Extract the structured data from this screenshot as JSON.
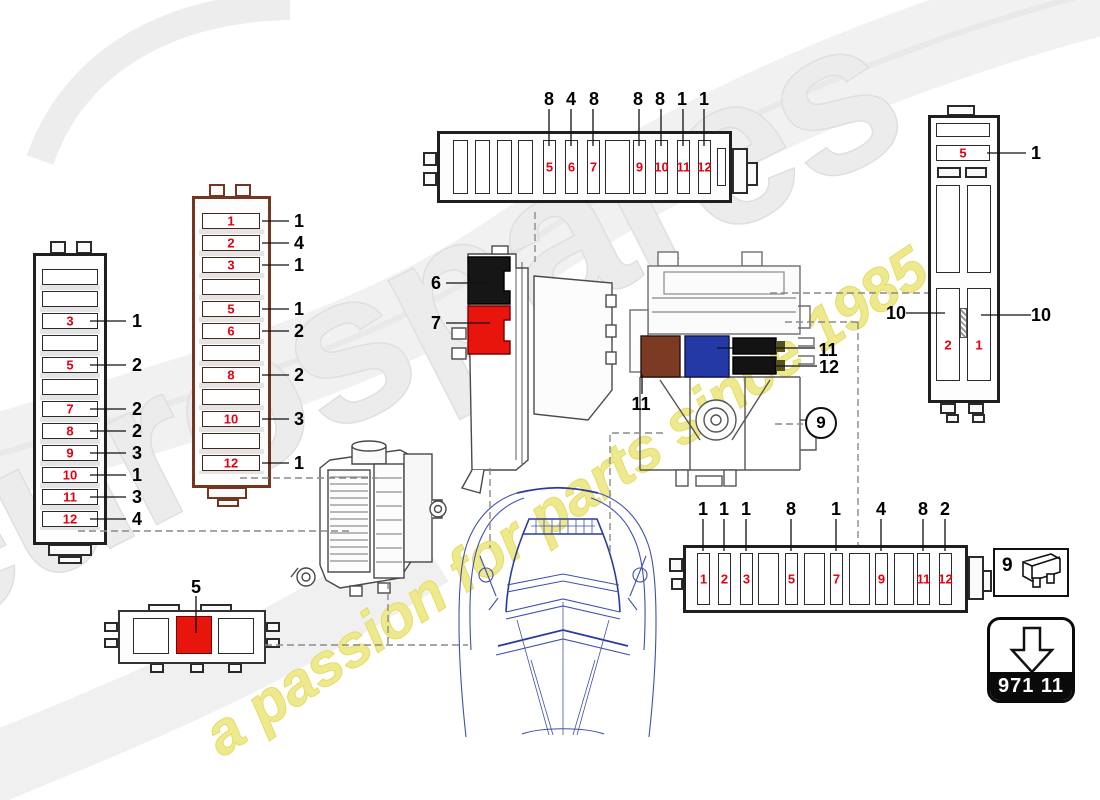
{
  "watermark": {
    "brand": "eurospares",
    "slogan": "a passion for parts since 1985",
    "brand_color": "#ececec",
    "slogan_color": "#efe98d"
  },
  "colors": {
    "fuse_number_red": "#e50011",
    "red_block": "#e8150d",
    "brown_block": "#7d3a22",
    "blue_block": "#2438a6",
    "black_block": "#131313",
    "panel_outline_black": "#1f1f1f",
    "panel_outline_brown": "#733621",
    "car_outline_blue": "#4150ac"
  },
  "top_fusebox": {
    "slots": [
      {
        "fuse": "",
        "callout": ""
      },
      {
        "fuse": "",
        "callout": ""
      },
      {
        "fuse": "",
        "callout": ""
      },
      {
        "fuse": "",
        "callout": ""
      },
      {
        "fuse": "5",
        "callout": "8"
      },
      {
        "fuse": "6",
        "callout": "4"
      },
      {
        "fuse": "7",
        "callout": "8"
      },
      {
        "fuse": "",
        "callout": ""
      },
      {
        "fuse": "9",
        "callout": "8"
      },
      {
        "fuse": "10",
        "callout": "8"
      },
      {
        "fuse": "11",
        "callout": "1"
      },
      {
        "fuse": "12",
        "callout": "1"
      }
    ]
  },
  "bottom_fusebox": {
    "slots": [
      {
        "fuse": "1",
        "callout": "1"
      },
      {
        "fuse": "2",
        "callout": "1"
      },
      {
        "fuse": "3",
        "callout": "1"
      },
      {
        "fuse": "",
        "callout": ""
      },
      {
        "fuse": "5",
        "callout": "8"
      },
      {
        "fuse": "",
        "callout": ""
      },
      {
        "fuse": "7",
        "callout": "1"
      },
      {
        "fuse": "",
        "callout": ""
      },
      {
        "fuse": "9",
        "callout": "4"
      },
      {
        "fuse": "",
        "callout": ""
      },
      {
        "fuse": "11",
        "callout": "8"
      },
      {
        "fuse": "12",
        "callout": "2"
      }
    ]
  },
  "left_panel": {
    "rows": [
      {
        "fuse": "",
        "callout": ""
      },
      {
        "fuse": "",
        "callout": ""
      },
      {
        "fuse": "3",
        "callout": "1"
      },
      {
        "fuse": "",
        "callout": ""
      },
      {
        "fuse": "5",
        "callout": "2"
      },
      {
        "fuse": "",
        "callout": ""
      },
      {
        "fuse": "7",
        "callout": "2"
      },
      {
        "fuse": "8",
        "callout": "2"
      },
      {
        "fuse": "9",
        "callout": "3"
      },
      {
        "fuse": "10",
        "callout": "1"
      },
      {
        "fuse": "11",
        "callout": "3"
      },
      {
        "fuse": "12",
        "callout": "4"
      }
    ]
  },
  "mid_panel": {
    "rows": [
      {
        "fuse": "1",
        "callout": "1"
      },
      {
        "fuse": "2",
        "callout": "4"
      },
      {
        "fuse": "3",
        "callout": "1"
      },
      {
        "fuse": "",
        "callout": ""
      },
      {
        "fuse": "5",
        "callout": "1"
      },
      {
        "fuse": "6",
        "callout": "2"
      },
      {
        "fuse": "",
        "callout": ""
      },
      {
        "fuse": "8",
        "callout": "2"
      },
      {
        "fuse": "",
        "callout": ""
      },
      {
        "fuse": "10",
        "callout": "3"
      },
      {
        "fuse": "",
        "callout": ""
      },
      {
        "fuse": "12",
        "callout": "1"
      }
    ]
  },
  "right_panel": {
    "rows": [
      {
        "fuse": "",
        "callout": ""
      },
      {
        "fuse": "5",
        "callout": "1"
      }
    ],
    "cells": {
      "bottom_left": "2",
      "bottom_right": "1"
    },
    "callout_left": "10",
    "callout_right": "10"
  },
  "center_assembly": {
    "black_label": "6",
    "red_label": "7"
  },
  "right_assembly": {
    "blue_label": "11",
    "black_label": "12",
    "brown_label": "11",
    "circle_ref": "9"
  },
  "relay_carrier": {
    "label": "5"
  },
  "legend": {
    "ref": "9"
  },
  "part_code_badge": {
    "code": "971 11"
  }
}
